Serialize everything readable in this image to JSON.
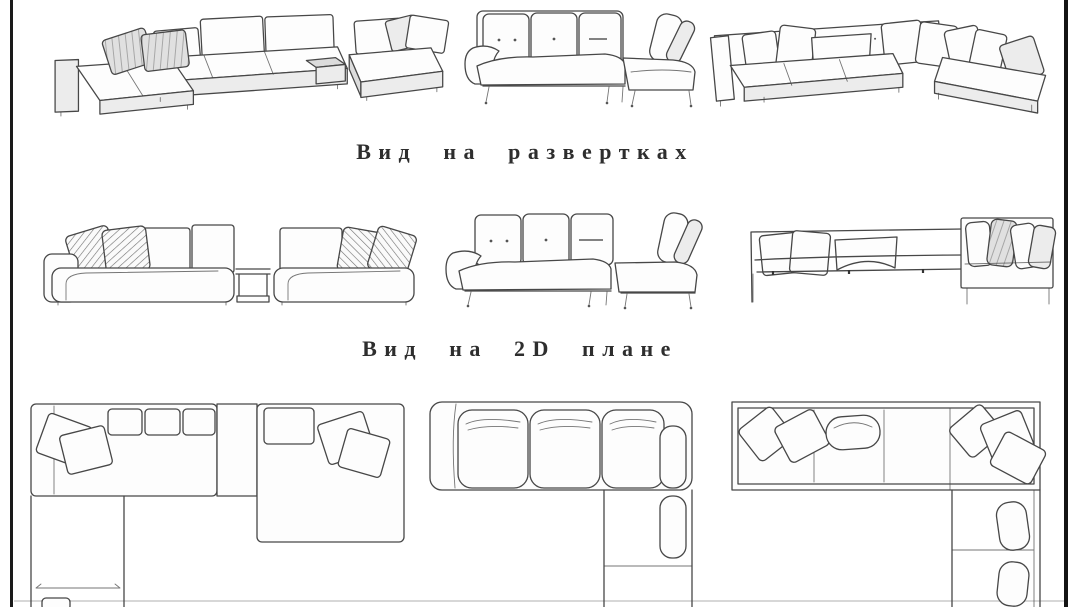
{
  "page": {
    "background_color": "#ffffff",
    "frame_color": "#1a1a1a",
    "line_color": "#474747",
    "text_color": "#2e2e2e"
  },
  "sections": {
    "perspective_row": {
      "drawings": [
        "modular-corner-sofa-with-left-chaise",
        "tufted-sofa-with-right-chaise",
        "corner-sofa-with-many-pillows"
      ]
    },
    "elevation_row": {
      "caption": "Вид на развертках",
      "drawings": [
        "modular-sofa-elevation",
        "tufted-sofa-elevation",
        "low-back-sofa-elevation"
      ]
    },
    "plan_row": {
      "caption": "Вид на 2D плане",
      "drawings": [
        "u-shaped-sofa-plan",
        "l-shaped-sofa-plan",
        "l-shaped-corner-sofa-plan"
      ]
    }
  }
}
